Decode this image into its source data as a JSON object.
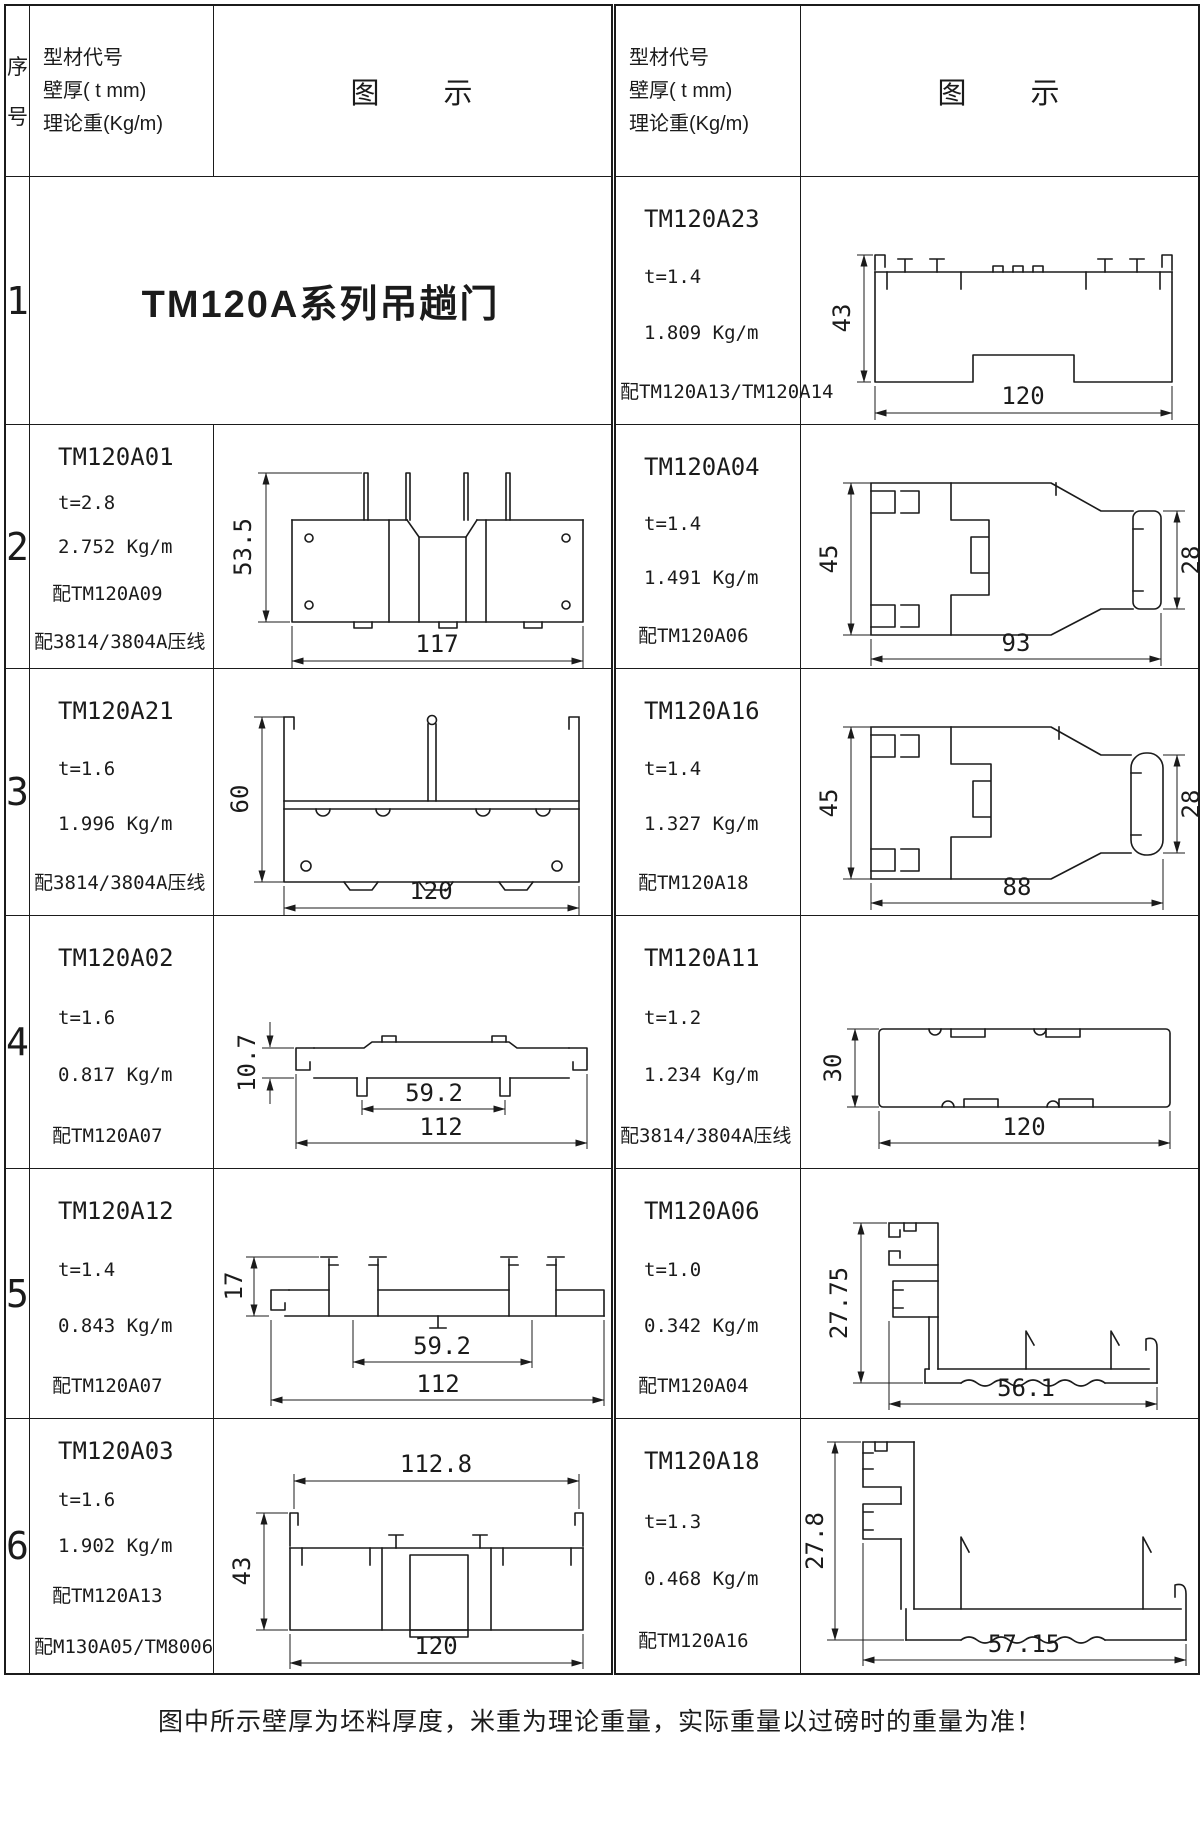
{
  "colors": {
    "ink": "#1b1b1b",
    "paper": "#ffffff"
  },
  "header": {
    "seq1": "序",
    "seq2": "号",
    "info1": "型材代号",
    "info2": "壁厚( t mm)",
    "info3": "理论重(Kg/m)",
    "diagram": "图　　示"
  },
  "rows": [
    {
      "no": "1",
      "left": {
        "title": "TM120A系列吊趟门"
      },
      "right": {
        "code": "TM120A23",
        "t": "t=1.4",
        "kg": "1.809 Kg/m",
        "m1": "配TM120A13/TM120A14",
        "dims": {
          "h": "43",
          "w": "120"
        }
      }
    },
    {
      "no": "2",
      "left": {
        "code": "TM120A01",
        "t": "t=2.8",
        "kg": "2.752 Kg/m",
        "m1": "配TM120A09",
        "m2": "配3814/3804A压线",
        "dims": {
          "h": "53.5",
          "w": "117"
        }
      },
      "right": {
        "code": "TM120A04",
        "t": "t=1.4",
        "kg": "1.491 Kg/m",
        "m1": "配TM120A06",
        "dims": {
          "h": "45",
          "h2": "28",
          "w": "93"
        }
      }
    },
    {
      "no": "3",
      "left": {
        "code": "TM120A21",
        "t": "t=1.6",
        "kg": "1.996 Kg/m",
        "m1": "配3814/3804A压线",
        "dims": {
          "h": "60",
          "w": "120"
        }
      },
      "right": {
        "code": "TM120A16",
        "t": "t=1.4",
        "kg": "1.327 Kg/m",
        "m1": "配TM120A18",
        "dims": {
          "h": "45",
          "h2": "28",
          "w": "88"
        }
      }
    },
    {
      "no": "4",
      "left": {
        "code": "TM120A02",
        "t": "t=1.6",
        "kg": "0.817 Kg/m",
        "m1": "配TM120A07",
        "dims": {
          "h": "10.7",
          "w1": "59.2",
          "w": "112"
        }
      },
      "right": {
        "code": "TM120A11",
        "t": "t=1.2",
        "kg": "1.234 Kg/m",
        "m1": "配3814/3804A压线",
        "dims": {
          "h": "30",
          "w": "120"
        }
      }
    },
    {
      "no": "5",
      "left": {
        "code": "TM120A12",
        "t": "t=1.4",
        "kg": "0.843 Kg/m",
        "m1": "配TM120A07",
        "dims": {
          "h": "17",
          "w1": "59.2",
          "w": "112"
        }
      },
      "right": {
        "code": "TM120A06",
        "t": "t=1.0",
        "kg": "0.342 Kg/m",
        "m1": "配TM120A04",
        "dims": {
          "h": "27.75",
          "w": "56.1"
        }
      }
    },
    {
      "no": "6",
      "left": {
        "code": "TM120A03",
        "t": "t=1.6",
        "kg": "1.902 Kg/m",
        "m1": "配TM120A13",
        "m2": "配M130A05/TM8006",
        "dims": {
          "h": "43",
          "w1": "112.8",
          "w": "120"
        }
      },
      "right": {
        "code": "TM120A18",
        "t": "t=1.3",
        "kg": "0.468 Kg/m",
        "m1": "配TM120A16",
        "dims": {
          "h": "27.8",
          "w": "57.15"
        }
      }
    }
  ],
  "footer": "图中所示壁厚为坯料厚度，米重为理论重量，实际重量以过磅时的重量为准！"
}
